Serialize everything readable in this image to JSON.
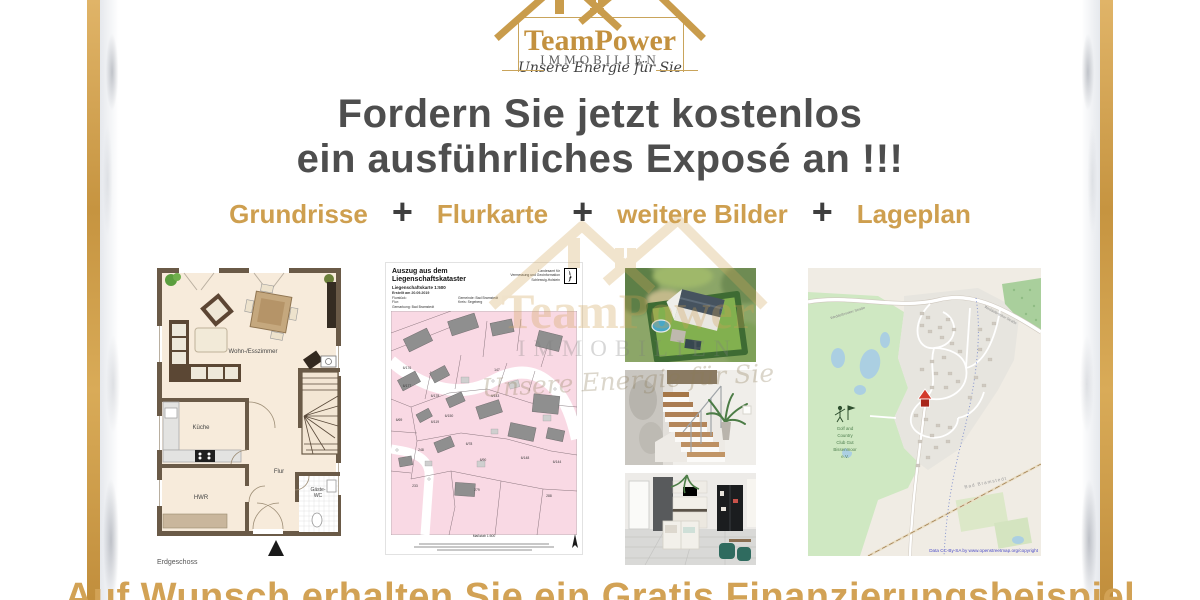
{
  "brand": {
    "name": "TeamPower",
    "industry": "IMMOBILIEN",
    "tagline": "Unsere Energie für Sie"
  },
  "headline": {
    "line1": "Fordern Sie jetzt kostenlos",
    "line2": "ein ausführliches Exposé an !!!"
  },
  "features": {
    "plus": "+",
    "items": [
      "Grundrisse",
      "Flurkarte",
      "weitere Bilder",
      "Lageplan"
    ]
  },
  "floorplan": {
    "caption": "Erdgeschoss",
    "rooms": {
      "living": "Wohn-/Esszimmer",
      "kitchen": "Küche",
      "hall": "Flur",
      "utility": "HWR",
      "wc_line1": "Gäste-",
      "wc_line2": "WC"
    }
  },
  "flurkarte": {
    "title_line1": "Auszug aus dem",
    "title_line2": "Liegenschaftskataster",
    "subtitle": "Liegenschaftskarte 1:500",
    "created": "Erstellt am 20.09.2019",
    "meta_left": [
      "Flurstück:",
      "Flur:",
      "Gemarkung: Bad Bramstedt"
    ],
    "meta_mid": [
      "Gemeinde: Bad Bramstedt",
      "Kreis: Segeberg"
    ],
    "agency_line1": "Landesamt für",
    "agency_line2": "Vermessung und Geoinformation",
    "agency_line3": "Schleswig-Holstein",
    "scale_label": "Maßstab 1:500",
    "parcels": [
      "6/176",
      "6/177",
      "6/178",
      "6/150",
      "6/119",
      "6/78",
      "147",
      "4/143",
      "6/90",
      "6/148",
      "6/144",
      "248",
      "233",
      "279",
      "288",
      "6/69"
    ]
  },
  "lageplan": {
    "club_lines": [
      "Golf and",
      "Country",
      "Club Gut",
      "Bissenmoor",
      "e.V."
    ],
    "street_label": "Weddelbrooker Straße",
    "city_label": "Bad Bramstedt",
    "copyright": "Data CC-By-SA by www.openstreetmap.org/copyright"
  },
  "footer": {
    "text": "Auf Wunsch erhalten Sie ein Gratis Finanzierungsbeispiel"
  },
  "colors": {
    "gold": "#CE9F4F",
    "headline_gray": "#4E4E4E",
    "frame_gold": "#D3A351",
    "map_pink": "#F9D9E4",
    "osm_green": "#CFE8C2",
    "marker_red": "#C23B2A"
  }
}
